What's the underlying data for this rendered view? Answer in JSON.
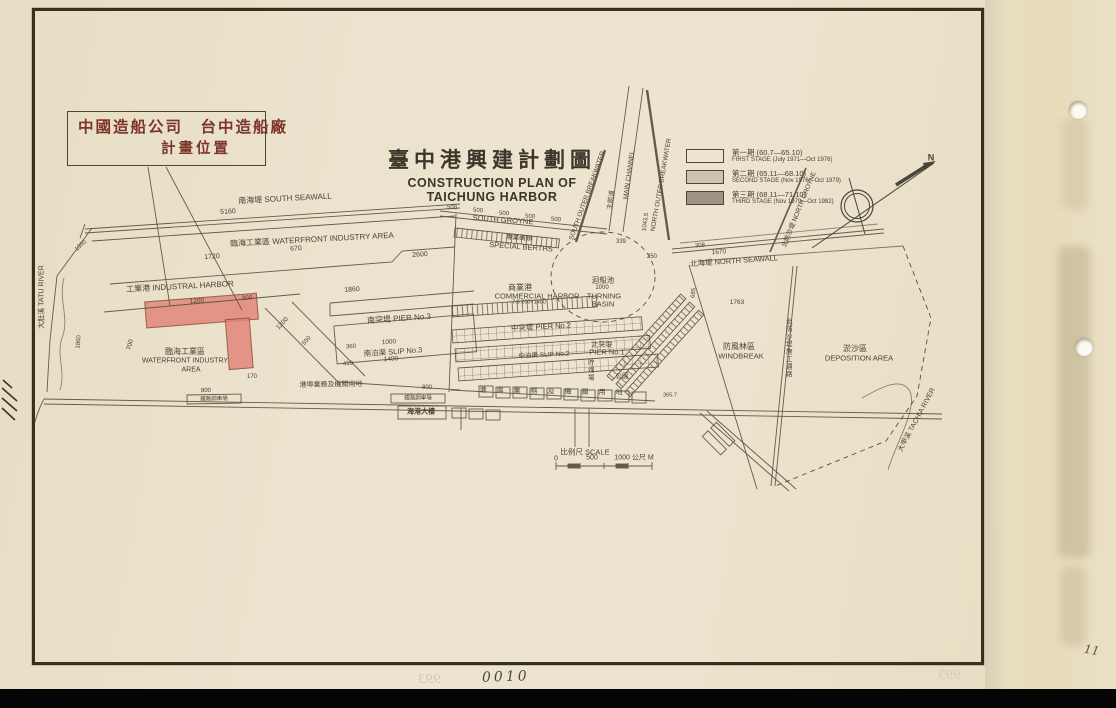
{
  "annotation_box": {
    "line1": "中國造船公司　台中造船廠",
    "line2": "計畫位置"
  },
  "title": {
    "zh": "臺中港興建計劃圖",
    "en1": "CONSTRUCTION PLAN OF",
    "en2": "TAICHUNG HARBOR"
  },
  "legend": {
    "items": [
      {
        "zh": "第一期 (60.7—65.10)",
        "en": "FIRST STAGE (July 1971—Oct 1976)",
        "swatch": "#ece4d0"
      },
      {
        "zh": "第二期 (65.11—68.10)",
        "en": "SECOND STAGE (Nov 1976—Oct 1979)",
        "swatch": "#cdc4ae"
      },
      {
        "zh": "第三期 (68.11—71.10)",
        "en": "THIRD STAGE (Nov 1979—Oct 1982)",
        "swatch": "#9d9486"
      }
    ]
  },
  "page": {
    "sheet_number": "0010",
    "page_number": "11",
    "bleed_number": "993"
  },
  "colors": {
    "paper": "#ebe3cd",
    "ink": "#4a4334",
    "highlight_pink": "#e28477",
    "annotation_red": "#7d352a"
  },
  "map": {
    "labels": [
      {
        "t": "南海堤 SOUTH SEAWALL",
        "x": 285,
        "y": 199,
        "s": 8,
        "r": -3
      },
      {
        "t": "5160",
        "x": 228,
        "y": 212,
        "s": 7,
        "r": -3
      },
      {
        "t": "臨海工業區 WATERFRONT INDUSTRY AREA",
        "x": 312,
        "y": 240,
        "s": 8,
        "r": -3
      },
      {
        "t": "1720",
        "x": 212,
        "y": 257,
        "s": 7,
        "r": -4
      },
      {
        "t": "670",
        "x": 296,
        "y": 249,
        "s": 7,
        "r": -4
      },
      {
        "t": "2600",
        "x": 420,
        "y": 255,
        "s": 7,
        "r": -4
      },
      {
        "t": "工業港 INDUSTRAL HARBOR",
        "x": 180,
        "y": 287,
        "s": 8,
        "r": -3
      },
      {
        "t": "1860",
        "x": 352,
        "y": 290,
        "s": 7,
        "r": -4
      },
      {
        "t": "1200",
        "x": 197,
        "y": 302,
        "s": 6.5,
        "r": -4
      },
      {
        "t": "300",
        "x": 247,
        "y": 299,
        "s": 6.5,
        "r": -4
      },
      {
        "t": "700",
        "x": 131,
        "y": 345,
        "s": 6.5,
        "r": -75
      },
      {
        "t": "臨海工業區",
        "x": 185,
        "y": 352,
        "s": 8,
        "r": 0
      },
      {
        "t": "WATERFRONT INDUSTRY",
        "x": 185,
        "y": 361,
        "s": 7,
        "r": 0
      },
      {
        "t": "AREA",
        "x": 191,
        "y": 370,
        "s": 7,
        "r": 0
      },
      {
        "t": "1200",
        "x": 283,
        "y": 324,
        "s": 6.5,
        "r": -48
      },
      {
        "t": "550",
        "x": 307,
        "y": 341,
        "s": 6,
        "r": -48
      },
      {
        "t": "170",
        "x": 252,
        "y": 377,
        "s": 6,
        "r": 0
      },
      {
        "t": "南突堤 PIER No.3",
        "x": 399,
        "y": 319,
        "s": 8,
        "r": -4
      },
      {
        "t": "1000",
        "x": 389,
        "y": 343,
        "s": 6.5,
        "r": -4
      },
      {
        "t": "360",
        "x": 351,
        "y": 347,
        "s": 6,
        "r": -4
      },
      {
        "t": "南泊渠 SLIP No.3",
        "x": 393,
        "y": 352,
        "s": 7.5,
        "r": -4
      },
      {
        "t": "1400",
        "x": 391,
        "y": 360,
        "s": 6.5,
        "r": -4
      },
      {
        "t": "410",
        "x": 348,
        "y": 364,
        "s": 6,
        "r": -4
      },
      {
        "t": "商業港",
        "x": 520,
        "y": 288,
        "s": 8,
        "r": 0
      },
      {
        "t": "COMMERCIAL HARBOR",
        "x": 537,
        "y": 296,
        "s": 7.5,
        "r": 0
      },
      {
        "t": "7.8 200×1400",
        "x": 529,
        "y": 303,
        "s": 5.5,
        "r": 0
      },
      {
        "t": "迴船池",
        "x": 603,
        "y": 280,
        "s": 7.5,
        "r": 0
      },
      {
        "t": "1000",
        "x": 602,
        "y": 288,
        "s": 6,
        "r": 0
      },
      {
        "t": "TURNING",
        "x": 604,
        "y": 296,
        "s": 7.5,
        "r": 0
      },
      {
        "t": "BASIN",
        "x": 603,
        "y": 304,
        "s": 7.5,
        "r": 0
      },
      {
        "t": "中突堤 PIER No.2",
        "x": 541,
        "y": 327,
        "s": 7.5,
        "r": -3
      },
      {
        "t": "中泊渠 SLIP No.2",
        "x": 544,
        "y": 356,
        "s": 6.5,
        "r": -3
      },
      {
        "t": "北突堤",
        "x": 602,
        "y": 345,
        "s": 7,
        "r": 0
      },
      {
        "t": "PIER No.1",
        "x": 607,
        "y": 352,
        "s": 7.5,
        "r": 0
      },
      {
        "t": "專業碼頭",
        "x": 519,
        "y": 239,
        "s": 6.5,
        "r": 4
      },
      {
        "t": "SPECIAL BERTHS",
        "x": 521,
        "y": 247,
        "s": 7.5,
        "r": 4
      },
      {
        "t": "SOUTH GROYNE",
        "x": 503,
        "y": 220,
        "s": 7.5,
        "r": 4
      },
      {
        "t": "500",
        "x": 452,
        "y": 208,
        "s": 6,
        "r": 4
      },
      {
        "t": "500",
        "x": 478,
        "y": 211,
        "s": 6,
        "r": 4
      },
      {
        "t": "500",
        "x": 504,
        "y": 214,
        "s": 6,
        "r": 4
      },
      {
        "t": "500",
        "x": 530,
        "y": 217,
        "s": 6,
        "r": 4
      },
      {
        "t": "500",
        "x": 556,
        "y": 220,
        "s": 6,
        "r": 4
      },
      {
        "t": "SOUTH OUTER BREAKWATER",
        "x": 588,
        "y": 196,
        "s": 6.5,
        "r": -70
      },
      {
        "t": "主航道",
        "x": 612,
        "y": 200,
        "s": 6.5,
        "r": -82
      },
      {
        "t": "MAIN CHANNEL",
        "x": 630,
        "y": 175,
        "s": 6.5,
        "r": -82
      },
      {
        "t": "NORTH OUTER BREAKWATER",
        "x": 662,
        "y": 185,
        "s": 6.5,
        "r": -80
      },
      {
        "t": "1043.5",
        "x": 646,
        "y": 222,
        "s": 6,
        "r": -82
      },
      {
        "t": "北防沙堤 NORTH GROYNE",
        "x": 800,
        "y": 210,
        "s": 6.5,
        "r": -68
      },
      {
        "t": "北海堤 NORTH SEAWALL",
        "x": 734,
        "y": 261,
        "s": 7.5,
        "r": -4
      },
      {
        "t": "1670",
        "x": 719,
        "y": 253,
        "s": 6.5,
        "r": -4
      },
      {
        "t": "250",
        "x": 652,
        "y": 257,
        "s": 6,
        "r": 0
      },
      {
        "t": "339",
        "x": 621,
        "y": 242,
        "s": 6,
        "r": 0
      },
      {
        "t": "308",
        "x": 700,
        "y": 246,
        "s": 6,
        "r": -4
      },
      {
        "t": "685",
        "x": 694,
        "y": 293,
        "s": 6,
        "r": -85
      },
      {
        "t": "1763",
        "x": 737,
        "y": 303,
        "s": 6.5,
        "r": 0
      },
      {
        "t": "防風林區",
        "x": 739,
        "y": 347,
        "s": 8,
        "r": 0
      },
      {
        "t": "WINDBREAK",
        "x": 741,
        "y": 356,
        "s": 7.5,
        "r": 0
      },
      {
        "t": "淤沙區",
        "x": 855,
        "y": 349,
        "s": 8,
        "r": 0
      },
      {
        "t": "DEPOSITION AREA",
        "x": 859,
        "y": 358,
        "s": 7.5,
        "r": 0
      },
      {
        "t": "北防沙堤施工通路",
        "x": 787,
        "y": 348,
        "s": 6.5,
        "r": 0,
        "cls": "vert"
      },
      {
        "t": "大肚溪 TATU RIVER",
        "x": 42,
        "y": 297,
        "s": 7,
        "r": -90
      },
      {
        "t": "1860",
        "x": 79,
        "y": 342,
        "s": 6,
        "r": -85
      },
      {
        "t": "1300",
        "x": 81,
        "y": 246,
        "s": 6,
        "r": -42
      },
      {
        "t": "大甲溪 TACHIA RIVER",
        "x": 917,
        "y": 420,
        "s": 7,
        "r": -62
      },
      {
        "t": "港埠業務及機關用地",
        "x": 331,
        "y": 385,
        "s": 7,
        "r": -1
      },
      {
        "t": "800",
        "x": 206,
        "y": 391,
        "s": 6,
        "r": -1
      },
      {
        "t": "鐵路調車場",
        "x": 214,
        "y": 400,
        "s": 5.5,
        "r": -1
      },
      {
        "t": "800",
        "x": 427,
        "y": 388,
        "s": 6,
        "r": 0
      },
      {
        "t": "鐵路調車場",
        "x": 418,
        "y": 399,
        "s": 5.5,
        "r": 0
      },
      {
        "t": "海港大樓",
        "x": 421,
        "y": 412,
        "s": 7,
        "r": 0,
        "cls": "bold"
      },
      {
        "t": "港埠業務及機關用地",
        "x": 556,
        "y": 392,
        "s": 7,
        "r": 1,
        "cls": "spread"
      },
      {
        "t": "貯煤場",
        "x": 589,
        "y": 370,
        "s": 6.5,
        "r": 0,
        "cls": "vert"
      },
      {
        "t": "公園",
        "x": 622,
        "y": 377,
        "s": 6.5,
        "r": 0
      },
      {
        "t": "365.7",
        "x": 670,
        "y": 396,
        "s": 5.5,
        "r": 0
      },
      {
        "t": "比例尺 SCALE",
        "x": 585,
        "y": 452,
        "s": 7.5,
        "r": 0
      },
      {
        "t": "0",
        "x": 556,
        "y": 459,
        "s": 7,
        "r": 0
      },
      {
        "t": "500",
        "x": 592,
        "y": 458,
        "s": 7,
        "r": 0
      },
      {
        "t": "1000 公尺 M",
        "x": 634,
        "y": 458,
        "s": 7,
        "r": 0
      },
      {
        "t": "N",
        "x": 931,
        "y": 158,
        "s": 9,
        "r": 0,
        "cls": "bold"
      }
    ]
  }
}
